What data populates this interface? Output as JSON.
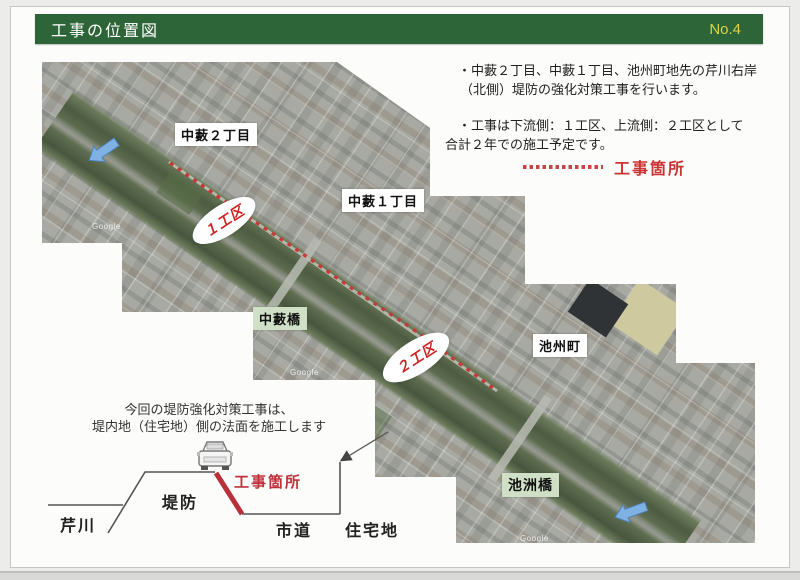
{
  "header": {
    "title": "工事の位置図",
    "page_no": "No.4"
  },
  "notes": {
    "line1": "・中藪２丁目、中藪１丁目、池州町地先の芹川右岸",
    "line2": "（北側）堤防の強化対策工事を行います。",
    "line3": "・工事は下流側：１工区、上流側：２工区として",
    "line4": "合計２年での施工予定です。"
  },
  "legend": {
    "label": "工事箇所"
  },
  "map": {
    "district_labels": [
      {
        "label": "中藪２丁目"
      },
      {
        "label": "中藪１丁目"
      },
      {
        "label": "池州町"
      }
    ],
    "bridge_labels": [
      {
        "label": "中藪橋"
      },
      {
        "label": "池洲橋"
      }
    ],
    "zone_labels": [
      {
        "label": "１工区"
      },
      {
        "label": "２工区"
      }
    ],
    "watermark": "Google",
    "colors": {
      "work_dash_red": "#c43b3b",
      "river_green": "#4d5c42",
      "flow_arrow_blue": "#7fb2e2",
      "bridge_label_bg": "#cfe0c6"
    }
  },
  "diagram": {
    "caption_line1": "今回の堤防強化対策工事は、",
    "caption_line2": "堤内地（住宅地）側の法面を施工します",
    "labels": {
      "river": "芹川",
      "embankment": "堤防",
      "work": "工事箇所",
      "road": "市道",
      "residential": "住宅地"
    }
  },
  "colors": {
    "header_green": "#2e6538",
    "page_no_yellow": "#d8d44a",
    "accent_red": "#cc3333"
  }
}
